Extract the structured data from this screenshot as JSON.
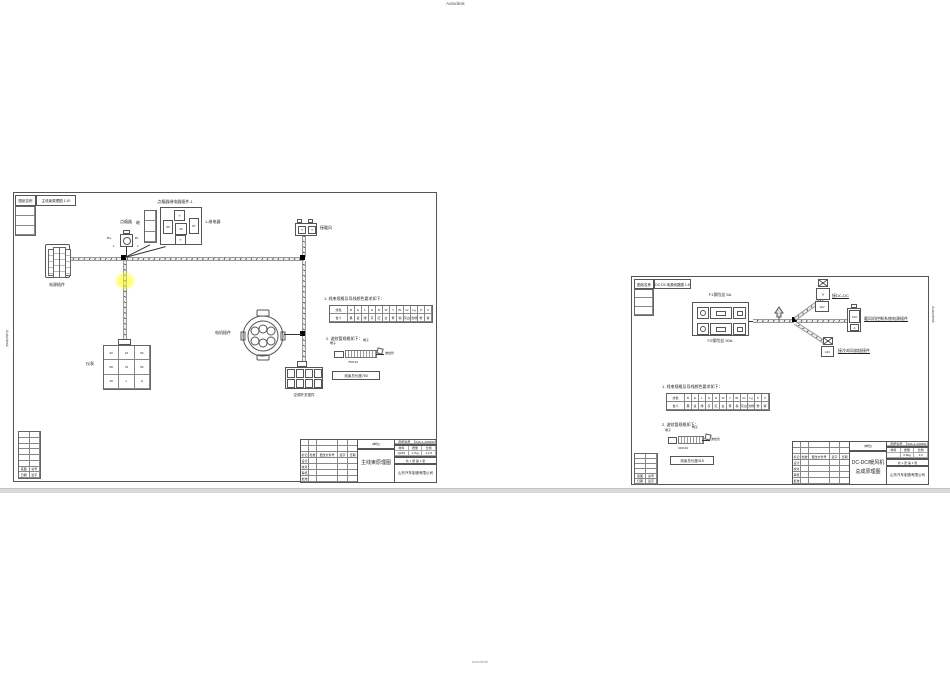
{
  "watermarks": {
    "top": "Autodesk",
    "bottom": "autodesk",
    "left_edge": "Autodesk",
    "right_edge": "Autodesk"
  },
  "left_sheet": {
    "header": {
      "label": "图纸名称",
      "value": "主线束原理图 1:10"
    },
    "fuse": {
      "title": "点烟器",
      "pin_left": "B/+",
      "pin_right": "B/-",
      "sub_left": "1",
      "sub_right": "1"
    },
    "relay": {
      "title": "点烟器继电器插件-1",
      "left_label": "继",
      "right_label": "1-继电器",
      "slots": [
        "",
        "",
        ""
      ],
      "cells": {
        "top": "T",
        "left": "85",
        "mid": "30",
        "right": "87",
        "bottom": "T"
      }
    },
    "power_connector_label": "电源插件",
    "heater": {
      "label": "接暖风",
      "cell1": "T",
      "cell2": "T"
    },
    "motor_label": "电机插件",
    "meter": {
      "label": "仪表",
      "cells": [
        "30",
        "15",
        "50",
        "58",
        "31",
        "56",
        "49",
        "L",
        "H"
      ]
    },
    "panel_label": "空调开关插件",
    "notes": {
      "n1": "1. 线束规格及导线颜色要求如下：",
      "n2": "2. 波纹管规格如下：",
      "sketch": {
        "t_left": "端子",
        "t_right": "端子",
        "tube": "波纹管",
        "dim": "750±10",
        "total": "线束总长度750"
      }
    },
    "wire_table": {
      "cells": [
        "线色",
        "B",
        "E",
        "L",
        "G",
        "R",
        "W",
        "Y",
        "Br",
        "Gr",
        "Lg",
        "P",
        "V",
        "含义",
        "黑",
        "蓝",
        "绿",
        "灰",
        "红",
        "白",
        "黄",
        "棕",
        "灰白",
        "浅绿",
        "粉",
        "紫"
      ]
    },
    "title_block": {
      "left_grid": [
        "",
        "",
        "",
        "",
        "",
        "",
        "",
        "",
        "",
        "",
        "标记",
        "处数",
        "更改文件号",
        "签字",
        "日期",
        "设计",
        "",
        "",
        "",
        "",
        "校对",
        "",
        "",
        "",
        "",
        "审核",
        "",
        "",
        "",
        "",
        "批准",
        "",
        "",
        "",
        ""
      ],
      "unit": "(单位)",
      "title": "主线束原理图",
      "title2": "",
      "row1": [
        "图纸编号",
        "04A-4-A00000"
      ],
      "rows23": [
        "材料",
        "质量",
        "比例",
        "Q235",
        "1.7kg",
        "1:2.5"
      ],
      "sheets": "共 1 张  第 1 张",
      "company": "山东汽车制造有限公司"
    },
    "corner": {
      "cells": [
        "",
        "",
        "",
        "",
        "",
        "",
        "",
        "",
        "",
        "",
        "",
        "",
        "底图",
        "总号",
        "日期",
        "签字"
      ]
    },
    "rev_strip": [
      "",
      "",
      ""
    ]
  },
  "right_sheet": {
    "header": {
      "label": "图纸名称",
      "value": "DC-DC电源线路图 1:5"
    },
    "fuse_box": {
      "f1": "F1保险丝  5A",
      "f2": "F2保险丝  20A"
    },
    "dcdc": {
      "label": "接DC-DC",
      "sym": "Y",
      "v": "12V"
    },
    "heater": {
      "label": "暖风机控制系统电源插件",
      "v": "12V",
      "a": "A"
    },
    "fan": {
      "label": "接冷却风扇插接件",
      "v": "12V"
    },
    "notes": {
      "n1": "1. 线束规格及导线颜色要求如下：",
      "n2": "2. 波纹管规格如下：",
      "sketch": {
        "t_left": "端子",
        "t_right": "端子",
        "tube": "波纹管",
        "dim": "315±10",
        "total": "线束总长度318"
      }
    },
    "wire_table": {
      "cells": [
        "线色",
        "B",
        "E",
        "L",
        "G",
        "R",
        "W",
        "Y",
        "Br",
        "Gr",
        "Lg",
        "P",
        "V",
        "含义",
        "黑",
        "蓝",
        "绿",
        "灰",
        "红",
        "白",
        "黄",
        "棕",
        "灰白",
        "浅绿",
        "粉",
        "紫"
      ]
    },
    "title_block": {
      "left_grid": [
        "",
        "",
        "",
        "",
        "",
        "",
        "",
        "",
        "",
        "",
        "标记",
        "处数",
        "更改文件号",
        "签字",
        "日期",
        "设计",
        "",
        "",
        "",
        "",
        "校对",
        "",
        "",
        "",
        "",
        "审核",
        "",
        "",
        "",
        "",
        "批准",
        "",
        "",
        "",
        ""
      ],
      "unit": "(单位)",
      "title": "DC-DC/暖风机",
      "title2": "总成原理图",
      "row1": [
        "图纸编号",
        "04A-4-A00001"
      ],
      "rows23": [
        "材料",
        "质量",
        "比例",
        "",
        "0.6kg",
        "1:2"
      ],
      "sheets": "共 1 张  第 1 张",
      "company": "山东汽车制造有限公司"
    },
    "corner": {
      "cells": [
        "",
        "",
        "",
        "",
        "",
        "",
        "",
        "",
        "底图",
        "总号",
        "日期",
        "签字"
      ]
    },
    "rev_strip": [
      "",
      "",
      ""
    ]
  }
}
